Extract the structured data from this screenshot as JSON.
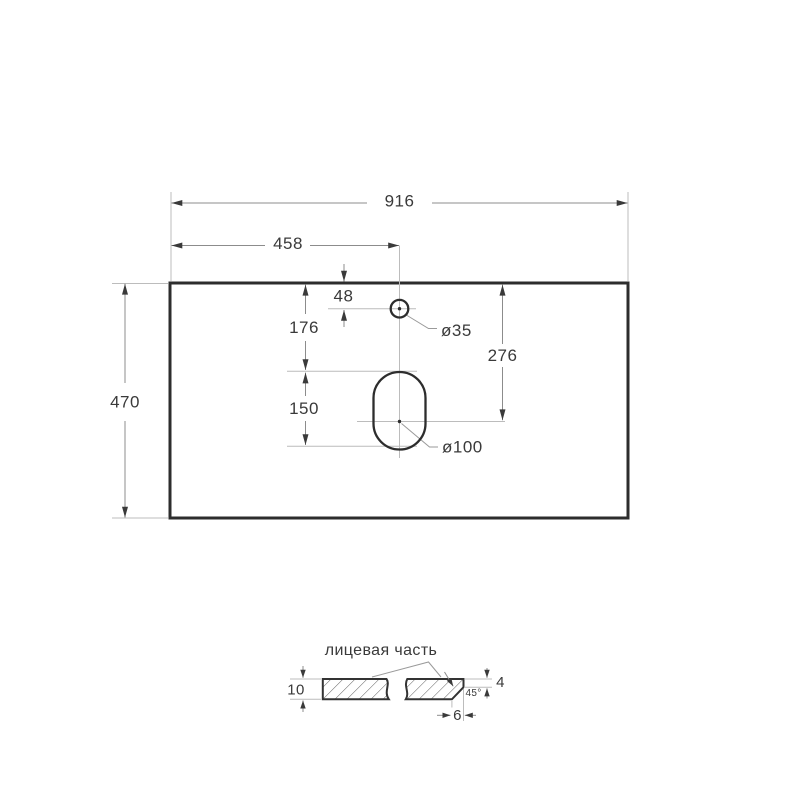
{
  "top_view": {
    "dim_total_width": "916",
    "dim_left_to_center": "458",
    "dim_depth": "470",
    "dim_top_to_faucet": "48",
    "dim_top_to_slot": "176",
    "dim_slot_length": "150",
    "dim_top_to_drain_axis": "276",
    "label_faucet_hole": "ø35",
    "label_drain_slot": "ø100"
  },
  "section_view": {
    "face_label": "лицевая часть",
    "dim_thickness": "10",
    "dim_edge_height": "4",
    "angle_label": "45°",
    "dim_chamfer_width": "6"
  },
  "colors": {
    "outline": "#2d2d2d",
    "dimension_line": "#8c8c8c",
    "extension_line": "#bcbcbc",
    "arrow": "#3a3a3a",
    "text": "#3a3a3a",
    "hatch": "#606060",
    "background": "#ffffff"
  }
}
